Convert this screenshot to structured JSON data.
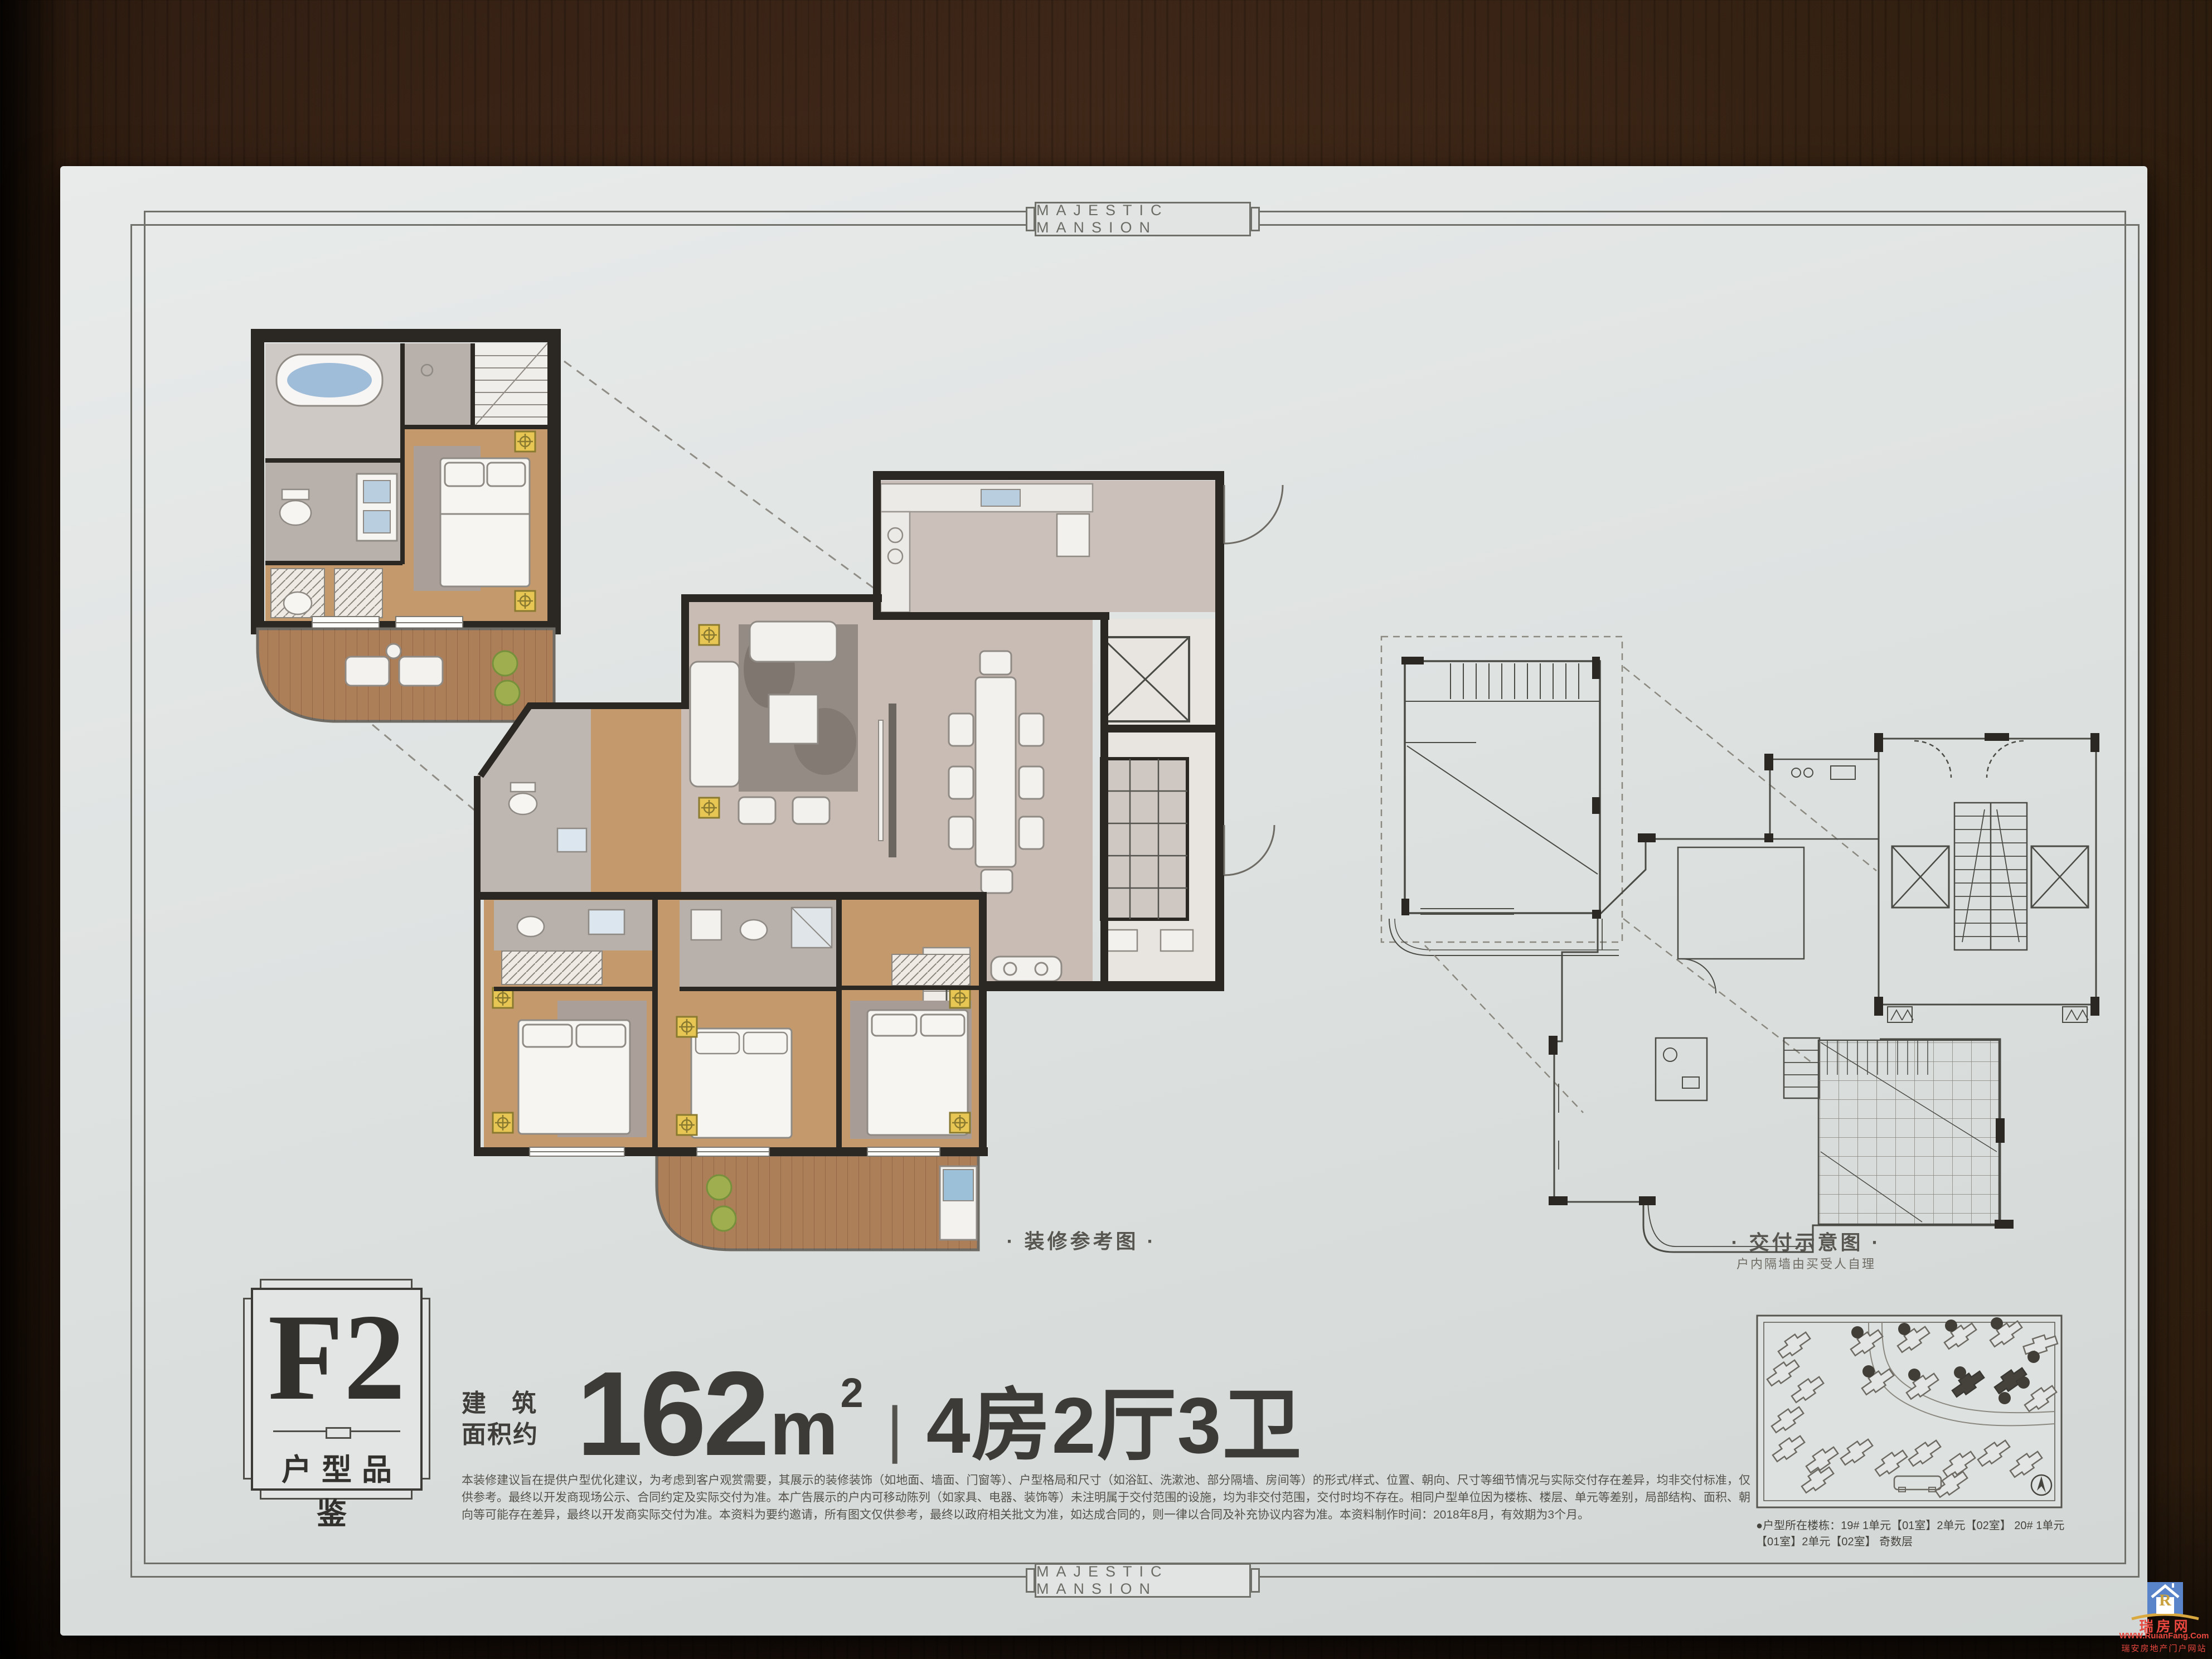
{
  "page": {
    "header_title": "MAJESTIC MANSION",
    "footer_title": "MAJESTIC MANSION"
  },
  "emblem": {
    "code": "F2",
    "tagline": "户型品鉴"
  },
  "area": {
    "prefix_top": "建筑",
    "prefix_bottom": "面积约",
    "value": "162",
    "unit": "m",
    "unit_sup": "2",
    "separator": "|",
    "rooms": "4房2厅3卫"
  },
  "plan_labels": {
    "decorated": "· 装修参考图 ·",
    "delivery": "· 交付示意图 ·",
    "delivery_note": "户内隔墙由买受人自理"
  },
  "disclaimer": "本装修建议旨在提供户型优化建议，为考虑到客户观赏需要，其展示的装修装饰（如地面、墙面、门窗等）、户型格局和尺寸（如浴缸、洗漱池、部分隔墙、房间等）的形式/样式、位置、朝向、尺寸等细节情况与实际交付存在差异，均非交付标准，仅供参考。最终以开发商现场公示、合同约定及实际交付为准。本广告展示的户内可移动陈列（如家具、电器、装饰等）未注明属于交付范围的设施，均为非交付范围，交付时均不存在。相同户型单位因为楼栋、楼层、单元等差别，局部结构、面积、朝向等可能存在差异，最终以开发商实际交付为准。本资料为要约邀请，所有图文仅供参考，最终以政府相关批文为准，如达成合同的，则一律以合同及补充协议内容为准。本资料制作时间：2018年8月，有效期为3个月。",
  "building_note": "●户型所在楼栋：19# 1单元【01室】2单元【02室】 20# 1单元【01室】2单元【02室】 奇数层",
  "watermark": {
    "logo_letter": "R",
    "site_name": "瑞房网",
    "url": "WWW.RuianFang.Com",
    "slogan": "瑞安房地产门户网站"
  },
  "colors": {
    "paper": "#dee2e1",
    "table_wood": "#3a2316",
    "wall": "#2b2723",
    "wood_floor": "#c49a6c",
    "deck": "#ad7f58",
    "marble": "#c9bcb5",
    "tile": "#b7b0ab",
    "highlight_yellow": "#e7c654",
    "plant_green": "#9fae4e",
    "water_blue": "#8fb3d4",
    "watermark_blue": "#5a84c9",
    "watermark_red": "#e8473f",
    "line_drawing": "#4b4b46"
  },
  "icons": [
    {
      "name": "compass-icon",
      "glyph": "◉"
    },
    {
      "name": "house-logo-icon",
      "glyph": "⌂"
    }
  ]
}
